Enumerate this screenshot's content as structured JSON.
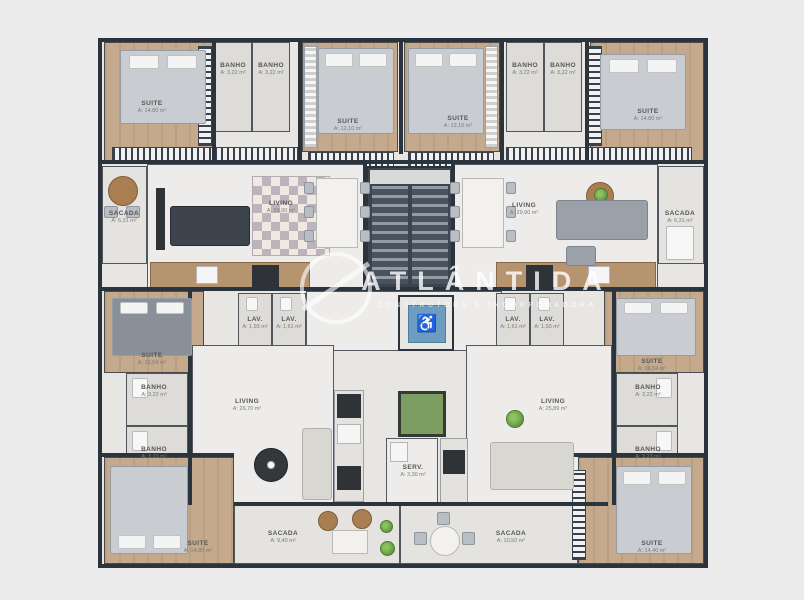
{
  "watermark": {
    "title": "ATLÂNTIDA",
    "subtitle": "CONSTRUTORA E INCORPORADORA"
  },
  "icons": {
    "accessibility_icon": "♿"
  },
  "colors": {
    "wall": "#2b333d",
    "wood_floor": "#c4a98c",
    "elevator_blue": "#6d9cbf",
    "plant_green": "#6fae4e",
    "page_background": "#ececec"
  },
  "rooms": {
    "suite_tl": {
      "name": "SUITE",
      "area": "A: 14,80 m²"
    },
    "banho_tl1": {
      "name": "BANHO",
      "area": "A: 3,22 m²"
    },
    "banho_tl2": {
      "name": "BANHO",
      "area": "A: 3,22 m²"
    },
    "suite_tml": {
      "name": "SUITE",
      "area": "A: 12,10 m²"
    },
    "suite_tmr": {
      "name": "SUITE",
      "area": "A: 12,10 m²"
    },
    "banho_tr1": {
      "name": "BANHO",
      "area": "A: 3,22 m²"
    },
    "banho_tr2": {
      "name": "BANHO",
      "area": "A: 3,22 m²"
    },
    "suite_tr": {
      "name": "SUITE",
      "area": "A: 14,80 m²"
    },
    "sacada_l": {
      "name": "SACADA",
      "area": "A: 6,31 m²"
    },
    "living_tl": {
      "name": "LIVING",
      "area": "A: 29,90 m²"
    },
    "living_tr": {
      "name": "LIVING",
      "area": "A: 29,90 m²"
    },
    "sacada_r": {
      "name": "SACADA",
      "area": "A: 6,31 m²"
    },
    "lav_l1": {
      "name": "LAV.",
      "area": "A: 1,93 m²"
    },
    "lav_l2": {
      "name": "LAV.",
      "area": "A: 1,61 m²"
    },
    "lav_r1": {
      "name": "LAV.",
      "area": "A: 1,61 m²"
    },
    "lav_r2": {
      "name": "LAV.",
      "area": "A: 1,93 m²"
    },
    "suite_ml": {
      "name": "SUITE",
      "area": "A: 16,54 m²"
    },
    "banho_ml1": {
      "name": "BANHO",
      "area": "A: 3,22 m²"
    },
    "banho_ml2": {
      "name": "BANHO",
      "area": "A: 3,23 m²"
    },
    "suite_mr": {
      "name": "SUITE",
      "area": "A: 16,54 m²"
    },
    "banho_mr1": {
      "name": "BANHO",
      "area": "A: 3,22 m²"
    },
    "banho_mr2": {
      "name": "BANHO",
      "area": "A: 3,23 m²"
    },
    "living_bl": {
      "name": "LIVING",
      "area": "A: 26,70 m²"
    },
    "living_br": {
      "name": "LIVING",
      "area": "A: 25,89 m²"
    },
    "serv": {
      "name": "SERV.",
      "area": "A: 3,30 m²"
    },
    "suite_bl": {
      "name": "SUITE",
      "area": "A: 14,80 m²"
    },
    "sacada_bl": {
      "name": "SACADA",
      "area": "A: 9,40 m²"
    },
    "sacada_br": {
      "name": "SACADA",
      "area": "A: 10,50 m²"
    },
    "suite_br": {
      "name": "SUITE",
      "area": "A: 14,40 m²"
    }
  }
}
